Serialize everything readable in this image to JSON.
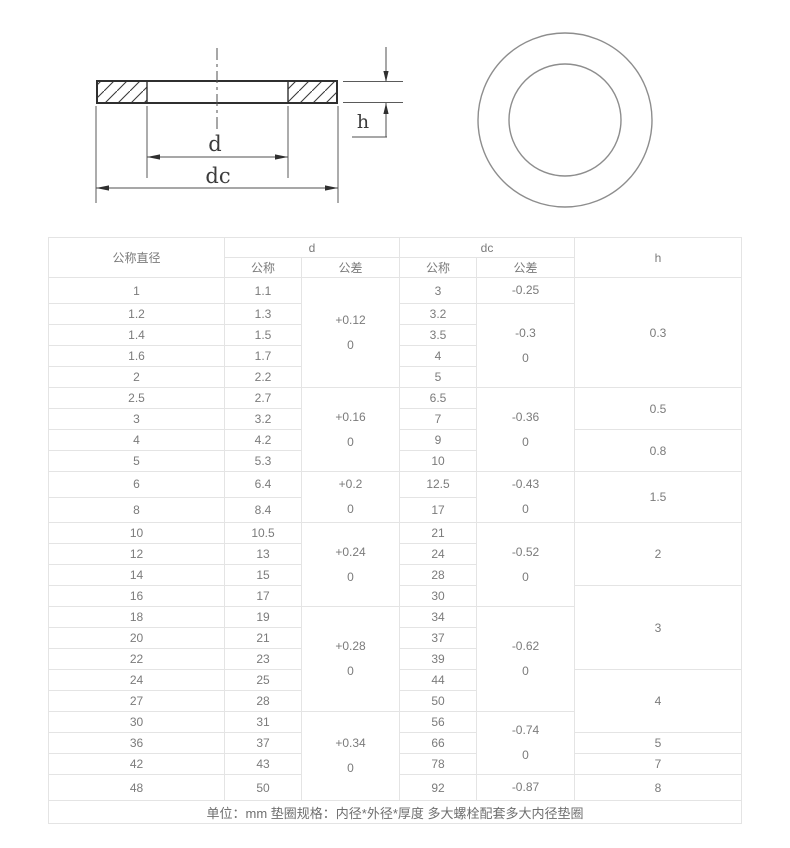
{
  "drawing": {
    "dim_d": "d",
    "dim_dc": "dc",
    "dim_h": "h"
  },
  "colors": {
    "section_line": "#3a3a3a",
    "dimension_line": "#4f4f4f",
    "circle_line": "#8d8d8d",
    "table_border": "#e4e4e4",
    "table_text": "#7b7b7b"
  },
  "table": {
    "header": {
      "nominal_diameter": "公称直径",
      "d": "d",
      "dc": "dc",
      "h": "h",
      "sub_nominal_d": "公称",
      "sub_tolerance_d": "公差",
      "sub_nominal_dc": "公称",
      "sub_tolerance_dc": "公差"
    },
    "rows": [
      {
        "nominal": "1",
        "d": "1.1",
        "dc": "3"
      },
      {
        "nominal": "1.2",
        "d": "1.3",
        "dc": "3.2"
      },
      {
        "nominal": "1.4",
        "d": "1.5",
        "dc": "3.5"
      },
      {
        "nominal": "1.6",
        "d": "1.7",
        "dc": "4"
      },
      {
        "nominal": "2",
        "d": "2.2",
        "dc": "5"
      },
      {
        "nominal": "2.5",
        "d": "2.7",
        "dc": "6.5"
      },
      {
        "nominal": "3",
        "d": "3.2",
        "dc": "7"
      },
      {
        "nominal": "4",
        "d": "4.2",
        "dc": "9"
      },
      {
        "nominal": "5",
        "d": "5.3",
        "dc": "10"
      },
      {
        "nominal": "6",
        "d": "6.4",
        "dc": "12.5"
      },
      {
        "nominal": "8",
        "d": "8.4",
        "dc": "17"
      },
      {
        "nominal": "10",
        "d": "10.5",
        "dc": "21"
      },
      {
        "nominal": "12",
        "d": "13",
        "dc": "24"
      },
      {
        "nominal": "14",
        "d": "15",
        "dc": "28"
      },
      {
        "nominal": "16",
        "d": "17",
        "dc": "30"
      },
      {
        "nominal": "18",
        "d": "19",
        "dc": "34"
      },
      {
        "nominal": "20",
        "d": "21",
        "dc": "37"
      },
      {
        "nominal": "22",
        "d": "23",
        "dc": "39"
      },
      {
        "nominal": "24",
        "d": "25",
        "dc": "44"
      },
      {
        "nominal": "27",
        "d": "28",
        "dc": "50"
      },
      {
        "nominal": "30",
        "d": "31",
        "dc": "56"
      },
      {
        "nominal": "36",
        "d": "37",
        "dc": "66"
      },
      {
        "nominal": "42",
        "d": "43",
        "dc": "78"
      },
      {
        "nominal": "48",
        "d": "50",
        "dc": "92"
      }
    ],
    "d_tolerance_groups": [
      {
        "start": 0,
        "span": 5,
        "lines": [
          "+0.12",
          "0"
        ]
      },
      {
        "start": 5,
        "span": 4,
        "lines": [
          "+0.16",
          "0"
        ]
      },
      {
        "start": 9,
        "span": 2,
        "lines": [
          "+0.2",
          "0"
        ]
      },
      {
        "start": 11,
        "span": 4,
        "lines": [
          "+0.24",
          "0"
        ]
      },
      {
        "start": 15,
        "span": 5,
        "lines": [
          "+0.28",
          "0"
        ]
      },
      {
        "start": 20,
        "span": 4,
        "lines": [
          "+0.34",
          "0"
        ]
      }
    ],
    "dc_tolerance_groups": [
      {
        "start": 0,
        "span": 1,
        "lines": [
          "-0.25"
        ]
      },
      {
        "start": 1,
        "span": 4,
        "lines": [
          "-0.3",
          "0"
        ]
      },
      {
        "start": 5,
        "span": 4,
        "lines": [
          "-0.36",
          "0"
        ]
      },
      {
        "start": 9,
        "span": 2,
        "lines": [
          "-0.43",
          "0"
        ]
      },
      {
        "start": 11,
        "span": 4,
        "lines": [
          "-0.52",
          "0"
        ]
      },
      {
        "start": 15,
        "span": 5,
        "lines": [
          "-0.62",
          "0"
        ]
      },
      {
        "start": 20,
        "span": 3,
        "lines": [
          "-0.74",
          "0"
        ]
      },
      {
        "start": 23,
        "span": 1,
        "lines": [
          "-0.87"
        ]
      }
    ],
    "h_groups": [
      {
        "start": 0,
        "span": 5,
        "value": "0.3"
      },
      {
        "start": 5,
        "span": 2,
        "value": "0.5"
      },
      {
        "start": 7,
        "span": 2,
        "value": "0.8"
      },
      {
        "start": 9,
        "span": 2,
        "value": "1.5"
      },
      {
        "start": 11,
        "span": 3,
        "value": "2"
      },
      {
        "start": 14,
        "span": 4,
        "value": "3"
      },
      {
        "start": 18,
        "span": 3,
        "value": "4"
      },
      {
        "start": 21,
        "span": 1,
        "value": "5"
      },
      {
        "start": 22,
        "span": 1,
        "value": "7"
      },
      {
        "start": 23,
        "span": 1,
        "value": "8"
      }
    ],
    "footer": "单位：mm 垫圈规格：内径*外径*厚度 多大螺栓配套多大内径垫圈"
  }
}
